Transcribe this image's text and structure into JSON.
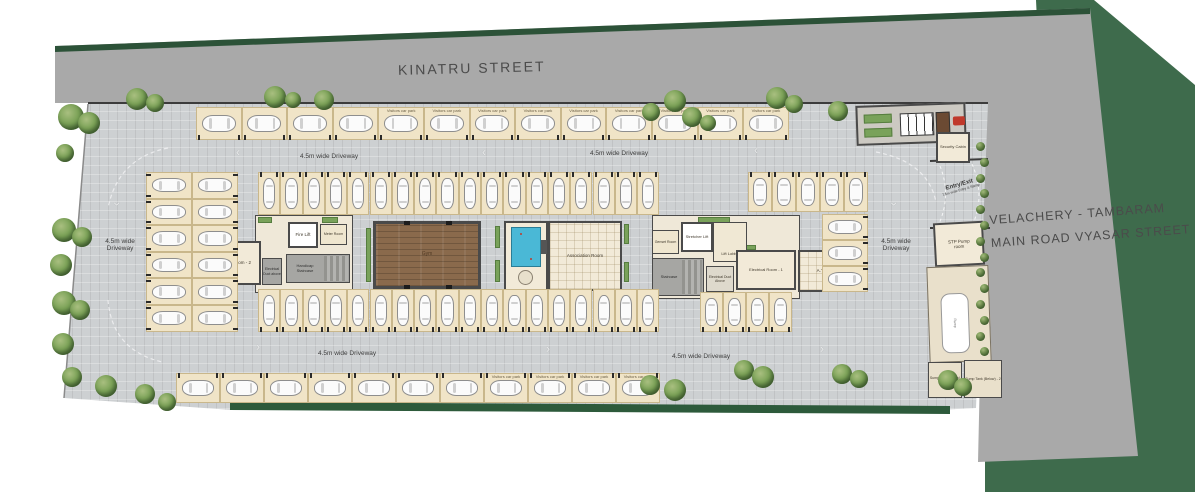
{
  "streets": {
    "top": "KINATRU STREET",
    "right_line1": "VELACHERY - TAMBARAM",
    "right_line2": "MAIN ROAD VYASAR STREET"
  },
  "labels": {
    "driveway": "4.5m wide Driveway",
    "driveway_l1": "4.5m wide",
    "driveway_l2": "Driveway",
    "visitors": "Visitors car park"
  },
  "rooms": {
    "fire_lift": "Fire Lift",
    "meter": "Meter Room",
    "stair_left": "Handicap Staircase",
    "elec_room_2": "Electrical Room - 2",
    "duct_left": "Electrical Duct above",
    "gym": "Gym",
    "indoor_games": "Indoor Games",
    "association": "Association Room",
    "genset": "Genset Room",
    "stretcher_lift": "Stretcher Lift",
    "lift_lobby": "Lift Lobby",
    "stair_right": "Staircase",
    "duct_right": "Electrical Duct Above",
    "elec_room_1": "Electrical Room - 1",
    "atb": "A.T.B",
    "security": "Security Cabin",
    "entry": "Entry/Exit",
    "entry_sub": "7.5m wide Entry & Ramp",
    "stp": "STP Pump room",
    "ramp": "Ramp",
    "sump_1": "Sump Tank (Below) - 1",
    "sump_2": "Sump Tank (Below) - 2"
  },
  "colors": {
    "road": "#a9a9a9",
    "green_bg": "#3e6b4c",
    "green_strip": "#2c5238",
    "hedge": "#2d5a3b",
    "site": "#cdd0d2",
    "stall": "#f0e4c7",
    "room": "#f2ead8",
    "wall": "#4a4a4a",
    "wood": "#8a6a4c",
    "pool": "#4ab8d6",
    "red_unit": "#c0392b",
    "text": "#4f4f4f"
  }
}
